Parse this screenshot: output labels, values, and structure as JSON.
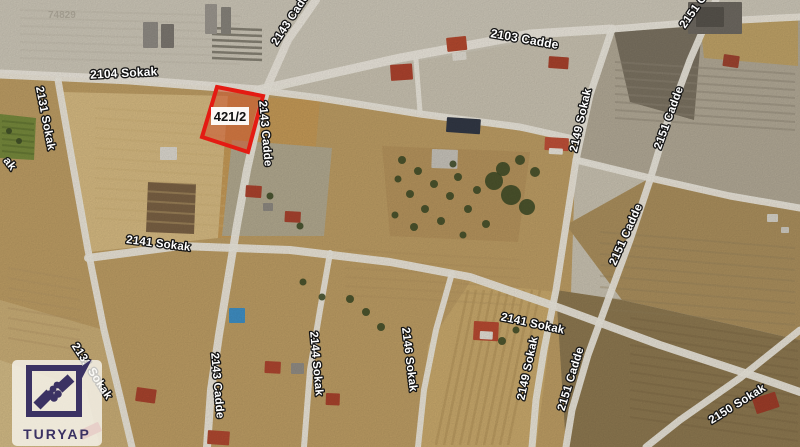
{
  "map": {
    "background": "#c9c2b1",
    "road_color": "#ece8dd",
    "tree_color": "#3c4a26",
    "watermark": {
      "text": "74829",
      "x": 48,
      "y": 18,
      "color": "#8e887b",
      "opacity": 0.55,
      "size": 10
    },
    "logo": {
      "brand": "TURYAP",
      "emblem_color": "#3b3263"
    },
    "parcel": {
      "label": "421/2",
      "points": "217,87 263,96 248,152 202,137",
      "fill": "rgba(205,85,45,0.55)",
      "stroke": "#e41b13",
      "stroke_width": 4,
      "label_box": {
        "x": 211,
        "y": 107,
        "w": 38,
        "h": 18,
        "fill": "rgba(255,255,255,0.95)"
      },
      "label_pos": {
        "x": 230,
        "y": 121
      },
      "label_color": "#111111",
      "label_size": 13
    },
    "label_style": {
      "fill": "#ffffff",
      "stroke": "#151515",
      "stroke_width": 2.6,
      "size": 11.5
    },
    "street_labels": [
      {
        "text": "2104 Sokak",
        "x": 124,
        "y": 77,
        "rot": -3,
        "size": 12
      },
      {
        "text": "2103 Cadde",
        "x": 524,
        "y": 43,
        "rot": 10,
        "size": 12
      },
      {
        "text": "2143 Cadde",
        "x": 277,
        "y": 46,
        "rot": -57,
        "anchor": "start"
      },
      {
        "text": "2131 Sokak",
        "x": 42,
        "y": 119,
        "rot": 79
      },
      {
        "text": "ak",
        "x": 7,
        "y": 166,
        "rot": 52
      },
      {
        "text": "2143 Cadde",
        "x": 262,
        "y": 134,
        "rot": 85
      },
      {
        "text": "2151 Cadde",
        "x": 685,
        "y": 29,
        "rot": -55,
        "anchor": "start"
      },
      {
        "text": "2149 Sokak",
        "x": 584,
        "y": 121,
        "rot": -77
      },
      {
        "text": "2151 Cadde",
        "x": 672,
        "y": 119,
        "rot": -70
      },
      {
        "text": "2151 Cadde",
        "x": 629,
        "y": 236,
        "rot": -66
      },
      {
        "text": "2141 Sokak",
        "x": 158,
        "y": 247,
        "rot": 7
      },
      {
        "text": "2141 Sokak",
        "x": 532,
        "y": 327,
        "rot": 12
      },
      {
        "text": "2146 Sokak",
        "x": 406,
        "y": 360,
        "rot": 83
      },
      {
        "text": "2149 Sokak",
        "x": 531,
        "y": 369,
        "rot": -78
      },
      {
        "text": "2151 Cadde",
        "x": 574,
        "y": 380,
        "rot": -73
      },
      {
        "text": "2150 Sokak",
        "x": 739,
        "y": 407,
        "rot": -32
      },
      {
        "text": "2131 Sokak",
        "x": 89,
        "y": 373,
        "rot": 57
      },
      {
        "text": "2143 Cadde",
        "x": 214,
        "y": 386,
        "rot": 85
      },
      {
        "text": "2144 Sokak",
        "x": 313,
        "y": 364,
        "rot": 85
      }
    ],
    "terrain": [
      {
        "points": "0,0 800,0 800,16 612,27 258,89 0,73",
        "fill": "#cdc7b8"
      },
      {
        "points": "612,27 800,16 800,208 650,177 576,158 590,95",
        "fill": "#b2a996"
      },
      {
        "points": "614,32 702,26 694,120 630,102",
        "fill": "#7b7261"
      },
      {
        "points": "700,20 798,14 798,66 704,58",
        "fill": "#bfa267"
      },
      {
        "points": "0,73 258,89 320,98 420,114 576,140 566,447 0,447",
        "fill": "#bd9d64"
      },
      {
        "points": "566,225 650,178 800,208 800,340 622,300",
        "fill": "#ab8f5d"
      },
      {
        "points": "556,290 622,300 800,340 800,447 566,447",
        "fill": "#8d7850"
      },
      {
        "points": "62,92 228,96 218,238 90,252",
        "fill": "#d6ba82"
      },
      {
        "points": "228,96 320,100 308,232 218,238",
        "fill": "#c59a57"
      },
      {
        "points": "232,140 332,148 324,236 222,236",
        "fill": "#b2a98f"
      },
      {
        "points": "148,182 196,184 194,234 146,232",
        "fill": "#7a6144"
      },
      {
        "points": "0,114 36,118 34,160 0,158",
        "fill": "#76893c"
      },
      {
        "points": "382,146 530,152 518,242 390,236",
        "fill": "#b6945d"
      },
      {
        "points": "0,300 104,330 122,405 132,447 0,447",
        "fill": "#c9ad76"
      },
      {
        "points": "0,360 86,390 100,447 0,447",
        "fill": "#d3bb86"
      },
      {
        "points": "470,282 556,292 536,447 420,447 428,345",
        "fill": "#c9a96c"
      }
    ],
    "stripes": [
      {
        "x1": 615,
        "y1": 62,
        "x2": 795,
        "y2": 74,
        "n": 8,
        "ox": 0,
        "oy": 8,
        "color": "#8f8676",
        "w": 2,
        "o": 0.45
      },
      {
        "x1": 468,
        "y1": 290,
        "x2": 436,
        "y2": 445,
        "n": 10,
        "ox": 8,
        "oy": 0,
        "color": "#a98a52",
        "w": 2.5,
        "o": 0.4
      },
      {
        "x1": 600,
        "y1": 232,
        "x2": 795,
        "y2": 248,
        "n": 8,
        "ox": 0,
        "oy": 11,
        "color": "#93805a",
        "w": 2,
        "o": 0.3
      },
      {
        "x1": 2,
        "y1": 121,
        "x2": 34,
        "y2": 124,
        "n": 6,
        "ox": 0,
        "oy": 6,
        "color": "#5d7030",
        "w": 2,
        "o": 0.6
      },
      {
        "x1": 20,
        "y1": 10,
        "x2": 240,
        "y2": 16,
        "n": 7,
        "ox": 0,
        "oy": 8,
        "color": "#c3bdad",
        "w": 2,
        "o": 0.5
      },
      {
        "x1": 212,
        "y1": 28,
        "x2": 262,
        "y2": 30,
        "n": 6,
        "ox": 0,
        "oy": 6,
        "color": "#565246",
        "w": 2.5,
        "o": 0.6
      },
      {
        "x1": 95,
        "y1": 108,
        "x2": 225,
        "y2": 116,
        "n": 12,
        "ox": 0,
        "oy": 10,
        "color": "#cdb076",
        "w": 2,
        "o": 0.38
      },
      {
        "x1": 630,
        "y1": 318,
        "x2": 798,
        "y2": 342,
        "n": 12,
        "ox": 0,
        "oy": 9,
        "color": "#7c6845",
        "w": 2,
        "o": 0.4
      },
      {
        "x1": 8,
        "y1": 268,
        "x2": 80,
        "y2": 280,
        "n": 8,
        "ox": 0,
        "oy": 10,
        "color": "#b39566",
        "w": 2,
        "o": 0.35
      },
      {
        "x1": 345,
        "y1": 250,
        "x2": 520,
        "y2": 260,
        "n": 6,
        "ox": 0,
        "oy": 9,
        "color": "#b2935f",
        "w": 2,
        "o": 0.3
      }
    ],
    "roads": [
      {
        "points": "0,74 130,80 258,90",
        "w": 9
      },
      {
        "points": "258,90 400,58 530,34 612,29",
        "w": 9
      },
      {
        "points": "612,29 700,22 800,17",
        "w": 7
      },
      {
        "points": "716,0 690,60 668,120 650,180 630,240 608,300 588,355 572,410 566,447",
        "w": 7
      },
      {
        "points": "612,29 590,95 576,160 566,225 556,290 544,350 536,400 532,447",
        "w": 7
      },
      {
        "points": "576,160 650,178 730,196 800,208",
        "w": 7
      },
      {
        "points": "316,0 288,40 268,85 258,120 247,170 237,225 228,280 219,335 211,390 207,447",
        "w": 8
      },
      {
        "points": "258,90 320,98 420,114 520,127 578,140",
        "w": 7
      },
      {
        "points": "88,258 180,246 290,250 390,262 470,277 560,308 660,345 760,378 800,392",
        "w": 8
      },
      {
        "points": "452,273 436,330 424,390 418,447",
        "w": 6
      },
      {
        "points": "330,253 320,310 310,370 304,447",
        "w": 6
      },
      {
        "points": "58,80 72,160 88,250 104,330 122,405 132,447",
        "w": 7
      },
      {
        "points": "800,330 740,378 680,420 646,447",
        "w": 7
      },
      {
        "points": "416,60 420,112",
        "w": 5
      }
    ],
    "structures": [
      {
        "x": 143,
        "y": 22,
        "w": 15,
        "h": 26,
        "rot": 0,
        "color": "#8f8b84"
      },
      {
        "x": 161,
        "y": 24,
        "w": 13,
        "h": 24,
        "rot": 0,
        "color": "#7c7770"
      },
      {
        "x": 205,
        "y": 4,
        "w": 12,
        "h": 30,
        "rot": 0,
        "color": "#9b968e"
      },
      {
        "x": 221,
        "y": 7,
        "w": 10,
        "h": 27,
        "rot": 0,
        "color": "#87837b"
      },
      {
        "x": 446,
        "y": 38,
        "w": 20,
        "h": 14,
        "rot": -6,
        "color": "#b4492f"
      },
      {
        "x": 452,
        "y": 53,
        "w": 14,
        "h": 8,
        "rot": -6,
        "color": "#e0dcd2"
      },
      {
        "x": 549,
        "y": 56,
        "w": 20,
        "h": 12,
        "rot": 4,
        "color": "#a8422c"
      },
      {
        "x": 688,
        "y": 2,
        "w": 54,
        "h": 32,
        "rot": 0,
        "color": "#6e6961"
      },
      {
        "x": 696,
        "y": 7,
        "w": 28,
        "h": 20,
        "rot": 0,
        "color": "#57534c"
      },
      {
        "x": 724,
        "y": 54,
        "w": 16,
        "h": 12,
        "rot": 8,
        "color": "#9e4430"
      },
      {
        "x": 390,
        "y": 65,
        "w": 22,
        "h": 16,
        "rot": -4,
        "color": "#ad432e"
      },
      {
        "x": 447,
        "y": 117,
        "w": 34,
        "h": 15,
        "rot": 4,
        "color": "#323845"
      },
      {
        "x": 545,
        "y": 137,
        "w": 24,
        "h": 13,
        "rot": 3,
        "color": "#bf5038"
      },
      {
        "x": 549,
        "y": 148,
        "w": 14,
        "h": 6,
        "rot": 3,
        "color": "#e8e4da"
      },
      {
        "x": 160,
        "y": 147,
        "w": 17,
        "h": 13,
        "rot": 0,
        "color": "#dcd8cf"
      },
      {
        "x": 432,
        "y": 149,
        "w": 26,
        "h": 19,
        "rot": 2,
        "color": "#c7c3ba"
      },
      {
        "x": 246,
        "y": 185,
        "w": 16,
        "h": 12,
        "rot": 4,
        "color": "#ab422d"
      },
      {
        "x": 285,
        "y": 211,
        "w": 16,
        "h": 11,
        "rot": 3,
        "color": "#a8432e"
      },
      {
        "x": 263,
        "y": 203,
        "w": 10,
        "h": 8,
        "rot": 0,
        "color": "#8d8880"
      },
      {
        "x": 767,
        "y": 214,
        "w": 11,
        "h": 8,
        "rot": 0,
        "color": "#d6d2c8"
      },
      {
        "x": 781,
        "y": 227,
        "w": 8,
        "h": 6,
        "rot": 0,
        "color": "#cfcbc1"
      },
      {
        "x": 474,
        "y": 321,
        "w": 25,
        "h": 19,
        "rot": 3,
        "color": "#b74a31"
      },
      {
        "x": 480,
        "y": 331,
        "w": 13,
        "h": 8,
        "rot": 3,
        "color": "#e2ded4"
      },
      {
        "x": 137,
        "y": 387,
        "w": 20,
        "h": 14,
        "rot": 8,
        "color": "#a8432d"
      },
      {
        "x": 208,
        "y": 430,
        "w": 22,
        "h": 14,
        "rot": 4,
        "color": "#b04830"
      },
      {
        "x": 265,
        "y": 361,
        "w": 16,
        "h": 12,
        "rot": 3,
        "color": "#ad452f"
      },
      {
        "x": 291,
        "y": 363,
        "w": 13,
        "h": 11,
        "rot": 0,
        "color": "#918c84"
      },
      {
        "x": 326,
        "y": 393,
        "w": 14,
        "h": 12,
        "rot": 2,
        "color": "#a8432c"
      },
      {
        "x": 752,
        "y": 399,
        "w": 24,
        "h": 16,
        "rot": -18,
        "color": "#9e3d29"
      },
      {
        "x": 78,
        "y": 431,
        "w": 22,
        "h": 10,
        "rot": -25,
        "color": "#b8463a"
      },
      {
        "x": 229,
        "y": 308,
        "w": 16,
        "h": 15,
        "rot": 0,
        "color": "#3f8fc4"
      }
    ],
    "trees": [
      {
        "x": 402,
        "y": 160,
        "r": 4
      },
      {
        "x": 418,
        "y": 171,
        "r": 4
      },
      {
        "x": 434,
        "y": 184,
        "r": 4
      },
      {
        "x": 450,
        "y": 196,
        "r": 4
      },
      {
        "x": 410,
        "y": 194,
        "r": 4
      },
      {
        "x": 425,
        "y": 209,
        "r": 4
      },
      {
        "x": 441,
        "y": 221,
        "r": 4
      },
      {
        "x": 398,
        "y": 179,
        "r": 3.5
      },
      {
        "x": 458,
        "y": 177,
        "r": 4
      },
      {
        "x": 468,
        "y": 209,
        "r": 4
      },
      {
        "x": 486,
        "y": 224,
        "r": 4
      },
      {
        "x": 414,
        "y": 227,
        "r": 4
      },
      {
        "x": 453,
        "y": 164,
        "r": 3.5
      },
      {
        "x": 477,
        "y": 190,
        "r": 4
      },
      {
        "x": 395,
        "y": 215,
        "r": 3.5
      },
      {
        "x": 463,
        "y": 235,
        "r": 3.5
      },
      {
        "x": 494,
        "y": 181,
        "r": 9
      },
      {
        "x": 511,
        "y": 195,
        "r": 10
      },
      {
        "x": 527,
        "y": 207,
        "r": 8
      },
      {
        "x": 503,
        "y": 169,
        "r": 7
      },
      {
        "x": 520,
        "y": 160,
        "r": 5
      },
      {
        "x": 535,
        "y": 172,
        "r": 5
      },
      {
        "x": 9,
        "y": 131,
        "r": 3
      },
      {
        "x": 19,
        "y": 141,
        "r": 3
      },
      {
        "x": 350,
        "y": 299,
        "r": 4
      },
      {
        "x": 366,
        "y": 312,
        "r": 4
      },
      {
        "x": 381,
        "y": 327,
        "r": 4
      },
      {
        "x": 303,
        "y": 282,
        "r": 3.5
      },
      {
        "x": 322,
        "y": 297,
        "r": 3.5
      },
      {
        "x": 270,
        "y": 196,
        "r": 3.5
      },
      {
        "x": 300,
        "y": 226,
        "r": 3.5
      },
      {
        "x": 502,
        "y": 341,
        "r": 4
      },
      {
        "x": 516,
        "y": 330,
        "r": 3.5
      }
    ]
  }
}
